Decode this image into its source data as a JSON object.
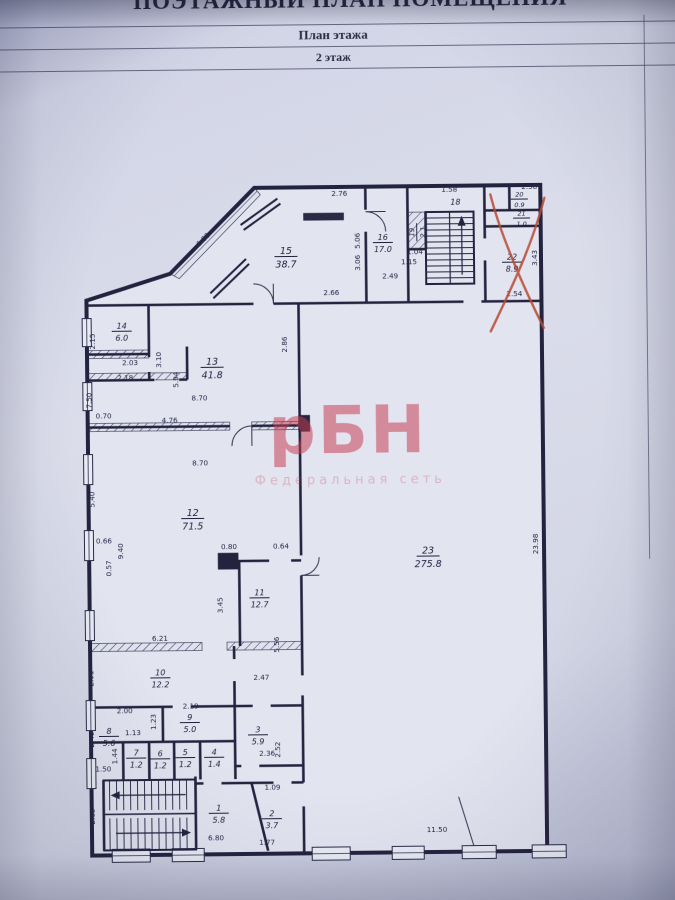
{
  "header": {
    "doc_title": "ПОЭТАЖНЫЙ ПЛАН ПОМЕЩЕНИЯ",
    "subtitle": "План этажа",
    "floor_label": "2 этаж"
  },
  "watermark": {
    "text": "рБН",
    "subtext": "Федеральная сеть",
    "color": "#c73e50"
  },
  "plan": {
    "wall_color": "#23233f",
    "crossed_out_room": "22",
    "cross_color": "#b84a32",
    "rooms": [
      {
        "n": "1",
        "a": "5.8",
        "x": 215,
        "y": 812
      },
      {
        "n": "2",
        "a": "3.7",
        "x": 268,
        "y": 818
      },
      {
        "n": "3",
        "a": "5.9",
        "x": 255,
        "y": 734
      },
      {
        "n": "4",
        "a": "1.4",
        "x": 211,
        "y": 756
      },
      {
        "n": "5",
        "a": "1.2",
        "x": 182,
        "y": 756
      },
      {
        "n": "6",
        "a": "1.2",
        "x": 157,
        "y": 757
      },
      {
        "n": "7",
        "a": "1.2",
        "x": 133,
        "y": 756
      },
      {
        "n": "8",
        "a": "5.6",
        "x": 106,
        "y": 734
      },
      {
        "n": "9",
        "a": "5.0",
        "x": 187,
        "y": 721
      },
      {
        "n": "10",
        "a": "12.2",
        "x": 158,
        "y": 676
      },
      {
        "n": "11",
        "a": "12.7",
        "x": 258,
        "y": 597
      },
      {
        "n": "12",
        "a": "71.5",
        "x": 192,
        "y": 517,
        "s": 9.5
      },
      {
        "n": "13",
        "a": "41.8",
        "x": 213,
        "y": 366,
        "s": 9.5
      },
      {
        "n": "14",
        "a": "6.0",
        "x": 123,
        "y": 329
      },
      {
        "n": "15",
        "a": "38.7",
        "x": 288,
        "y": 256,
        "s": 9.5
      },
      {
        "n": "16",
        "a": "17.0",
        "x": 385,
        "y": 243
      },
      {
        "n": "18",
        "a": "",
        "x": 458,
        "y": 206
      },
      {
        "n": "19",
        "a": "2.1",
        "x": 419,
        "y": 233,
        "r": -90,
        "s": 7
      },
      {
        "n": "20",
        "a": "0.9",
        "x": 522,
        "y": 201,
        "s": 6.5
      },
      {
        "n": "21",
        "a": "1.0",
        "x": 524,
        "y": 220,
        "s": 6.5
      },
      {
        "n": "22",
        "a": "8.9",
        "x": 514,
        "y": 264
      },
      {
        "n": "23",
        "a": "275.8",
        "x": 427,
        "y": 557,
        "s": 9.5
      }
    ],
    "dims": [
      {
        "t": "2.76",
        "x": 342,
        "y": 196
      },
      {
        "t": "1.58",
        "x": 452,
        "y": 193
      },
      {
        "t": "2.58",
        "x": 532,
        "y": 191
      },
      {
        "t": "6.00",
        "x": 207,
        "y": 240,
        "r": -45
      },
      {
        "t": "2.66",
        "x": 333,
        "y": 295
      },
      {
        "t": "2.86",
        "x": 288,
        "y": 344,
        "r": -90
      },
      {
        "t": "5.06",
        "x": 362,
        "y": 241,
        "r": -90
      },
      {
        "t": "3.06",
        "x": 362,
        "y": 263,
        "r": -90
      },
      {
        "t": "2.49",
        "x": 392,
        "y": 279
      },
      {
        "t": "1.15",
        "x": 411,
        "y": 265
      },
      {
        "t": "1.04",
        "x": 417,
        "y": 255
      },
      {
        "t": "2.54",
        "x": 516,
        "y": 298
      },
      {
        "t": "3.43",
        "x": 539,
        "y": 260,
        "r": -90
      },
      {
        "t": "2.15",
        "x": 96,
        "y": 339,
        "r": -90
      },
      {
        "t": "2.03",
        "x": 131,
        "y": 363
      },
      {
        "t": "2.18",
        "x": 126,
        "y": 378
      },
      {
        "t": "3.10",
        "x": 162,
        "y": 358,
        "r": -90
      },
      {
        "t": "5.94",
        "x": 179,
        "y": 378,
        "r": -90
      },
      {
        "t": "8.70",
        "x": 200,
        "y": 399
      },
      {
        "t": "0.70",
        "x": 104,
        "y": 416
      },
      {
        "t": "7.50",
        "x": 92,
        "y": 398,
        "r": -90
      },
      {
        "t": "4.76",
        "x": 170,
        "y": 421
      },
      {
        "t": "8.70",
        "x": 200,
        "y": 464
      },
      {
        "t": "5.40",
        "x": 94,
        "y": 497,
        "r": -90
      },
      {
        "t": "0.66",
        "x": 103,
        "y": 541
      },
      {
        "t": "9.40",
        "x": 122,
        "y": 549,
        "r": -90
      },
      {
        "t": "0.57",
        "x": 110,
        "y": 566,
        "r": -90
      },
      {
        "t": "0.80",
        "x": 228,
        "y": 548
      },
      {
        "t": "0.64",
        "x": 280,
        "y": 548
      },
      {
        "t": "23.98",
        "x": 537,
        "y": 546,
        "r": -90
      },
      {
        "t": "11.50",
        "x": 433,
        "y": 833
      },
      {
        "t": "3.45",
        "x": 221,
        "y": 604,
        "r": -90
      },
      {
        "t": "6.21",
        "x": 158,
        "y": 639
      },
      {
        "t": "5.56",
        "x": 277,
        "y": 644,
        "r": -90
      },
      {
        "t": "2.47",
        "x": 259,
        "y": 679
      },
      {
        "t": "2.01",
        "x": 91,
        "y": 676,
        "r": -90
      },
      {
        "t": "2.00",
        "x": 122,
        "y": 711
      },
      {
        "t": "2.19",
        "x": 188,
        "y": 707
      },
      {
        "t": "1.23",
        "x": 153,
        "y": 720,
        "r": -90
      },
      {
        "t": "1.13",
        "x": 130,
        "y": 733
      },
      {
        "t": "2.40",
        "x": 91,
        "y": 737,
        "r": -90
      },
      {
        "t": "1.44",
        "x": 114,
        "y": 754,
        "r": -90
      },
      {
        "t": "1.50",
        "x": 100,
        "y": 769
      },
      {
        "t": "2.36",
        "x": 264,
        "y": 755
      },
      {
        "t": "2.52",
        "x": 277,
        "y": 749,
        "r": -90
      },
      {
        "t": "1.09",
        "x": 269,
        "y": 789
      },
      {
        "t": "6.80",
        "x": 212,
        "y": 839
      },
      {
        "t": "1.77",
        "x": 263,
        "y": 844
      },
      {
        "t": "2.63",
        "x": 91,
        "y": 814,
        "r": -90
      }
    ]
  }
}
